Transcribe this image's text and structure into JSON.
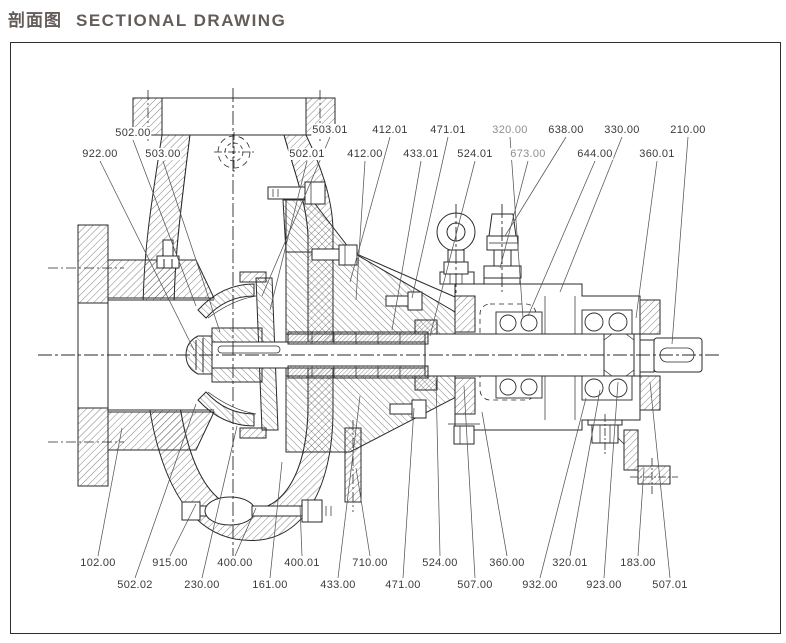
{
  "title": {
    "zh": "剖面图",
    "en": "SECTIONAL DRAWING"
  },
  "colors": {
    "title_text": "#645c58",
    "drawing_line": "#2a2a2a",
    "leader_line": "#555555",
    "label_text": "#3a3a3a",
    "frame_border": "#2f2f2f",
    "background": "#ffffff"
  },
  "drawing_title": "pump-sectional-drawing",
  "part_labels": [
    {
      "id": "502.00",
      "x": 133,
      "y": 133,
      "tx": 196,
      "ty": 306,
      "muted": false
    },
    {
      "id": "503.01",
      "x": 330,
      "y": 130,
      "tx": 262,
      "ty": 296,
      "muted": false
    },
    {
      "id": "412.01",
      "x": 390,
      "y": 130,
      "tx": 350,
      "ty": 282,
      "muted": false
    },
    {
      "id": "471.01",
      "x": 448,
      "y": 130,
      "tx": 412,
      "ty": 298,
      "muted": false
    },
    {
      "id": "320.00",
      "x": 510,
      "y": 130,
      "tx": 523,
      "ty": 318,
      "muted": true
    },
    {
      "id": "638.00",
      "x": 566,
      "y": 130,
      "tx": 505,
      "ty": 236,
      "muted": false
    },
    {
      "id": "330.00",
      "x": 622,
      "y": 130,
      "tx": 560,
      "ty": 292,
      "muted": false
    },
    {
      "id": "210.00",
      "x": 688,
      "y": 130,
      "tx": 672,
      "ty": 344,
      "muted": false
    },
    {
      "id": "922.00",
      "x": 100,
      "y": 154,
      "tx": 194,
      "ty": 350,
      "muted": false
    },
    {
      "id": "503.00",
      "x": 163,
      "y": 154,
      "tx": 220,
      "ty": 332,
      "muted": false
    },
    {
      "id": "502.01",
      "x": 307,
      "y": 154,
      "tx": 270,
      "ty": 310,
      "muted": false
    },
    {
      "id": "412.00",
      "x": 365,
      "y": 154,
      "tx": 356,
      "ty": 300,
      "muted": false
    },
    {
      "id": "433.01",
      "x": 421,
      "y": 154,
      "tx": 392,
      "ty": 330,
      "muted": false
    },
    {
      "id": "524.01",
      "x": 475,
      "y": 154,
      "tx": 430,
      "ty": 336,
      "muted": false
    },
    {
      "id": "673.00",
      "x": 528,
      "y": 154,
      "tx": 500,
      "ty": 268,
      "muted": true
    },
    {
      "id": "644.00",
      "x": 595,
      "y": 154,
      "tx": 528,
      "ty": 316,
      "muted": false
    },
    {
      "id": "360.01",
      "x": 657,
      "y": 154,
      "tx": 636,
      "ty": 318,
      "muted": false
    },
    {
      "id": "102.00",
      "x": 98,
      "y": 563,
      "tx": 122,
      "ty": 428,
      "muted": false
    },
    {
      "id": "915.00",
      "x": 170,
      "y": 563,
      "tx": 196,
      "ty": 504,
      "muted": false
    },
    {
      "id": "400.00",
      "x": 235,
      "y": 563,
      "tx": 256,
      "ty": 508,
      "muted": false
    },
    {
      "id": "400.01",
      "x": 302,
      "y": 563,
      "tx": 300,
      "ty": 506,
      "muted": false
    },
    {
      "id": "710.00",
      "x": 370,
      "y": 563,
      "tx": 356,
      "ty": 468,
      "muted": false
    },
    {
      "id": "524.00",
      "x": 440,
      "y": 563,
      "tx": 436,
      "ty": 380,
      "muted": false
    },
    {
      "id": "360.00",
      "x": 507,
      "y": 563,
      "tx": 482,
      "ty": 412,
      "muted": false
    },
    {
      "id": "320.01",
      "x": 570,
      "y": 563,
      "tx": 600,
      "ty": 390,
      "muted": false
    },
    {
      "id": "183.00",
      "x": 638,
      "y": 563,
      "tx": 644,
      "ty": 468,
      "muted": false
    },
    {
      "id": "502.02",
      "x": 135,
      "y": 585,
      "tx": 196,
      "ty": 404,
      "muted": false
    },
    {
      "id": "230.00",
      "x": 202,
      "y": 585,
      "tx": 237,
      "ty": 426,
      "muted": false
    },
    {
      "id": "161.00",
      "x": 270,
      "y": 585,
      "tx": 282,
      "ty": 462,
      "muted": false
    },
    {
      "id": "433.00",
      "x": 338,
      "y": 585,
      "tx": 360,
      "ty": 396,
      "muted": false
    },
    {
      "id": "471.00",
      "x": 403,
      "y": 585,
      "tx": 414,
      "ty": 408,
      "muted": false
    },
    {
      "id": "507.00",
      "x": 475,
      "y": 585,
      "tx": 464,
      "ty": 386,
      "muted": false
    },
    {
      "id": "932.00",
      "x": 540,
      "y": 585,
      "tx": 586,
      "ty": 398,
      "muted": false
    },
    {
      "id": "923.00",
      "x": 604,
      "y": 585,
      "tx": 618,
      "ty": 382,
      "muted": false
    },
    {
      "id": "507.01",
      "x": 670,
      "y": 585,
      "tx": 650,
      "ty": 382,
      "muted": false
    }
  ]
}
